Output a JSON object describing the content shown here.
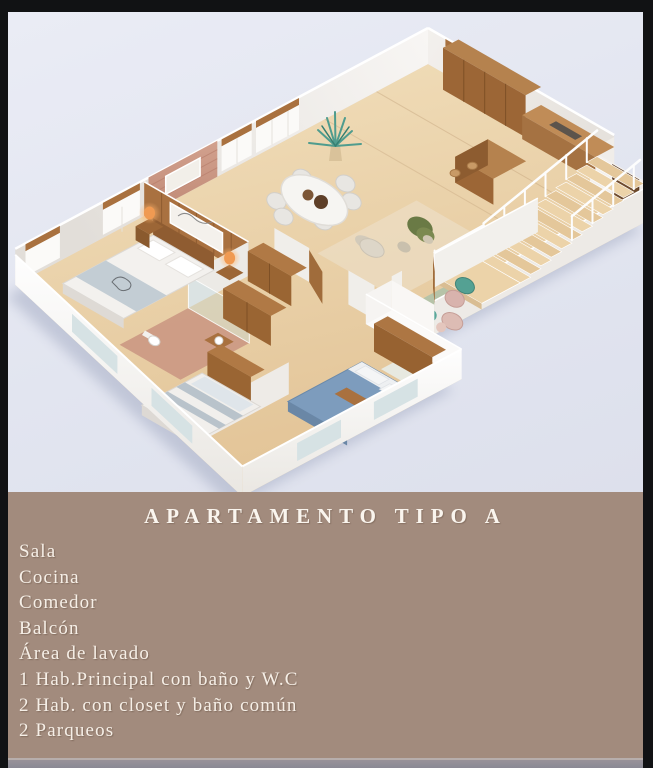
{
  "info_panel": {
    "title": "APARTAMENTO TIPO A",
    "features": [
      "Sala",
      "Cocina",
      "Comedor",
      "Balcón",
      "Área de lavado",
      "1 Hab.Principal con baño y W.C",
      "2 Hab. con closet y baño común",
      "2 Parqueos"
    ]
  },
  "colors": {
    "frame": "#111214",
    "photo_background": "#e4e6f0",
    "panel_background": "#a28b7d",
    "text": "#f6efe7",
    "floor_tan": "#ead0a6",
    "wood_accent": "#a9713f",
    "teal_accent": "#5aa79a",
    "lamp_orange": "#f09a52"
  }
}
